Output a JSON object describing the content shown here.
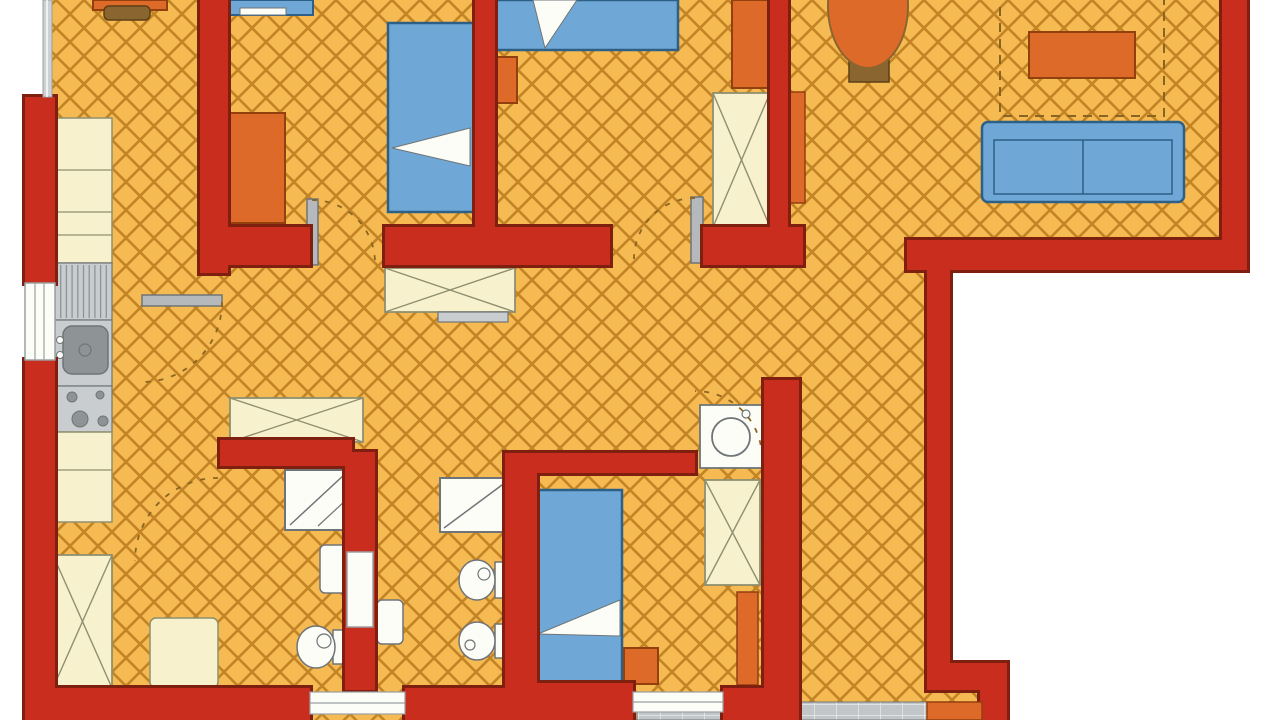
{
  "meta": {
    "type": "apartment-floor-plan",
    "canvas": {
      "width": 1280,
      "height": 720
    }
  },
  "palette": {
    "bg": "#ffffff",
    "floor_bg": "#f6ba52",
    "floor_line": "#c28425",
    "wall": "#c92d1d",
    "wall_dark": "#7e1f10",
    "blue": "#6fa8d6",
    "blue_dark": "#2e5f86",
    "orange": "#dd6a28",
    "orange_dark": "#93400f",
    "cream": "#f7f2cd",
    "cream_dark": "#8f8f70",
    "white": "#fdfdf8",
    "gray": "#b5b9bb",
    "gray_mid": "#c9cdcf",
    "gray_dark": "#6f7577",
    "steel": "#8e9496",
    "pave_bg": "#c2c6c8",
    "pave_line": "#e9ebeb",
    "pot": "#8a6530",
    "pot_dark": "#5d4015",
    "dash": "#8a6420",
    "win_glass": "#cdd1d3",
    "win_frame": "#9aa0a2"
  },
  "floor_polygon": "44,0 1247,0 1247,270 950,270 950,663 1007,663 1007,720 25,720 25,97 44,97",
  "balcony": {
    "x": 637,
    "y": 702,
    "w": 293,
    "h": 18
  },
  "furniture": [
    {
      "k": "rect",
      "n": "kitchen-desk",
      "x": 93,
      "y": 0,
      "w": 74,
      "h": 10,
      "f": "orange",
      "s": "orange_dark",
      "sw": 2
    },
    {
      "k": "rect",
      "n": "kitchen-chair",
      "x": 104,
      "y": 6,
      "w": 46,
      "h": 14,
      "rx": 5,
      "f": "pot",
      "s": "pot_dark",
      "sw": 1.5
    },
    {
      "k": "rect",
      "n": "kitchen-counter-upper",
      "x": 55,
      "y": 118,
      "w": 57,
      "h": 145,
      "f": "cream",
      "s": "cream_dark",
      "sw": 1.5
    },
    {
      "k": "line",
      "n": "counter-line",
      "x1": 55,
      "y1": 170,
      "x2": 112,
      "y2": 170,
      "s": "cream_dark",
      "sw": 1.2
    },
    {
      "k": "line",
      "n": "counter-line",
      "x1": 55,
      "y1": 212,
      "x2": 112,
      "y2": 212,
      "s": "cream_dark",
      "sw": 1.2
    },
    {
      "k": "line",
      "n": "counter-line",
      "x1": 55,
      "y1": 235,
      "x2": 112,
      "y2": 235,
      "s": "cream_dark",
      "sw": 1.2
    },
    {
      "k": "hatch",
      "n": "kitchen-drainer",
      "x": 55,
      "y": 263,
      "w": 57,
      "h": 57,
      "f": "gray_mid",
      "s": "gray_dark",
      "sw": 1.2,
      "lines": 9,
      "dir": "v"
    },
    {
      "k": "rect",
      "n": "kitchen-sink-counter",
      "x": 55,
      "y": 320,
      "w": 57,
      "h": 66,
      "f": "gray_mid",
      "s": "gray_dark",
      "sw": 1.2
    },
    {
      "k": "rect",
      "n": "kitchen-sink-basin",
      "x": 63,
      "y": 326,
      "w": 45,
      "h": 48,
      "rx": 9,
      "f": "steel",
      "s": "gray_dark",
      "sw": 1.5
    },
    {
      "k": "ellipse",
      "n": "faucet-dot",
      "cx": 60,
      "cy": 340,
      "rx": 3.5,
      "ry": 3.5,
      "f": "white",
      "s": "gray_dark",
      "sw": 1
    },
    {
      "k": "ellipse",
      "n": "faucet-dot",
      "cx": 60,
      "cy": 355,
      "rx": 3.5,
      "ry": 3.5,
      "f": "white",
      "s": "gray_dark",
      "sw": 1
    },
    {
      "k": "ellipse",
      "n": "sink-drain",
      "cx": 85,
      "cy": 350,
      "rx": 6,
      "ry": 6,
      "f": "none",
      "s": "gray_dark",
      "sw": 1.2
    },
    {
      "k": "rect",
      "n": "kitchen-stove",
      "x": 55,
      "y": 386,
      "w": 57,
      "h": 46,
      "f": "gray_mid",
      "s": "gray_dark",
      "sw": 1.2
    },
    {
      "k": "ellipse",
      "n": "stove-burner",
      "cx": 72,
      "cy": 397,
      "rx": 5,
      "ry": 5,
      "f": "steel",
      "s": "gray_dark",
      "sw": 1
    },
    {
      "k": "ellipse",
      "n": "stove-burner",
      "cx": 100,
      "cy": 395,
      "rx": 4,
      "ry": 4,
      "f": "steel",
      "s": "gray_dark",
      "sw": 1
    },
    {
      "k": "ellipse",
      "n": "stove-burner",
      "cx": 80,
      "cy": 419,
      "rx": 8,
      "ry": 8,
      "f": "steel",
      "s": "gray_dark",
      "sw": 1
    },
    {
      "k": "ellipse",
      "n": "stove-burner",
      "cx": 103,
      "cy": 421,
      "rx": 5,
      "ry": 5,
      "f": "steel",
      "s": "gray_dark",
      "sw": 1
    },
    {
      "k": "rect",
      "n": "kitchen-counter-lower",
      "x": 55,
      "y": 432,
      "w": 57,
      "h": 90,
      "f": "cream",
      "s": "cream_dark",
      "sw": 1.5
    },
    {
      "k": "line",
      "n": "counter-line",
      "x1": 55,
      "y1": 470,
      "x2": 112,
      "y2": 470,
      "s": "cream_dark",
      "sw": 1.2
    },
    {
      "k": "xbox",
      "n": "entry-wardrobe",
      "x": 53,
      "y": 555,
      "w": 59,
      "h": 133
    },
    {
      "k": "rect",
      "n": "entry-cabinet",
      "x": 150,
      "y": 618,
      "w": 68,
      "h": 70,
      "rx": 6,
      "f": "cream",
      "s": "cream_dark",
      "sw": 1.5
    },
    {
      "k": "rect",
      "n": "bed-1-stub",
      "x": 230,
      "y": 0,
      "w": 83,
      "h": 15,
      "f": "blue",
      "s": "blue_dark",
      "sw": 2
    },
    {
      "k": "rect",
      "n": "bed-1-stub-pillow",
      "x": 240,
      "y": 8,
      "w": 46,
      "h": 7,
      "f": "white",
      "s": "gray_dark",
      "sw": 1
    },
    {
      "k": "rect",
      "n": "bedroom1-dresser",
      "x": 230,
      "y": 113,
      "w": 55,
      "h": 110,
      "f": "orange",
      "s": "orange_dark",
      "sw": 2
    },
    {
      "k": "rect",
      "n": "bed-1",
      "x": 388,
      "y": 23,
      "w": 87,
      "h": 189,
      "f": "blue",
      "s": "blue_dark",
      "sw": 2.5
    },
    {
      "k": "polygon",
      "n": "bed-1-blanket",
      "points": "392,148 470,128 470,166",
      "f": "white",
      "s": "gray_dark",
      "sw": 1
    },
    {
      "k": "rect",
      "n": "bed-2",
      "x": 490,
      "y": 0,
      "w": 188,
      "h": 50,
      "f": "blue",
      "s": "blue_dark",
      "sw": 2.5
    },
    {
      "k": "polygon",
      "n": "bed-2-pillow",
      "points": "533,0 577,0 545,48",
      "f": "white",
      "s": "gray_dark",
      "sw": 1
    },
    {
      "k": "rect",
      "n": "bedroom2-nightstand",
      "x": 487,
      "y": 57,
      "w": 30,
      "h": 46,
      "f": "orange",
      "s": "orange_dark",
      "sw": 2
    },
    {
      "k": "rect",
      "n": "bedroom2-cabinet",
      "x": 732,
      "y": 0,
      "w": 38,
      "h": 88,
      "f": "orange",
      "s": "orange_dark",
      "sw": 2
    },
    {
      "k": "xbox",
      "n": "bedroom2-wardrobe",
      "x": 713,
      "y": 93,
      "w": 57,
      "h": 134
    },
    {
      "k": "xbox",
      "n": "hall-wardrobe",
      "x": 385,
      "y": 268,
      "w": 130,
      "h": 44
    },
    {
      "k": "rect",
      "n": "hall-shelf",
      "x": 438,
      "y": 312,
      "w": 70,
      "h": 10,
      "f": "gray_mid",
      "s": "gray_dark",
      "sw": 1.2
    },
    {
      "k": "xbox",
      "n": "hall-wardrobe-2",
      "x": 230,
      "y": 398,
      "w": 133,
      "h": 44
    },
    {
      "k": "rect",
      "n": "washing-machine",
      "x": 700,
      "y": 405,
      "w": 62,
      "h": 63,
      "f": "white",
      "s": "gray_dark",
      "sw": 1.8
    },
    {
      "k": "ellipse",
      "n": "washer-drum",
      "cx": 731,
      "cy": 437,
      "rx": 19,
      "ry": 19,
      "f": "none",
      "s": "gray_dark",
      "sw": 1.8
    },
    {
      "k": "ellipse",
      "n": "washer-knob",
      "cx": 746,
      "cy": 414,
      "rx": 4,
      "ry": 4,
      "f": "none",
      "s": "gray_dark",
      "sw": 1.2
    },
    {
      "k": "rect",
      "n": "plant-pot",
      "x": 849,
      "y": 56,
      "w": 40,
      "h": 26,
      "f": "pot",
      "s": "pot_dark",
      "sw": 1.5
    },
    {
      "k": "ellipse",
      "n": "plant",
      "cx": 868,
      "cy": 6,
      "rx": 40,
      "ry": 62,
      "f": "orange",
      "s": "pot",
      "sw": 2
    },
    {
      "k": "rect",
      "n": "rug-outline",
      "x": 1000,
      "y": -16,
      "w": 164,
      "h": 132,
      "f": "none",
      "s": "dash",
      "sw": 2,
      "dash": "9 7"
    },
    {
      "k": "rect",
      "n": "coffee-table",
      "x": 1029,
      "y": 32,
      "w": 106,
      "h": 46,
      "f": "orange",
      "s": "orange_dark",
      "sw": 2
    },
    {
      "k": "rect",
      "n": "sofa",
      "x": 982,
      "y": 122,
      "w": 202,
      "h": 80,
      "rx": 6,
      "f": "blue",
      "s": "blue_dark",
      "sw": 2.5
    },
    {
      "k": "rect",
      "n": "sofa-seat",
      "x": 994,
      "y": 140,
      "w": 178,
      "h": 54,
      "f": "none",
      "s": "blue_dark",
      "sw": 1.5
    },
    {
      "k": "line",
      "n": "sofa-divider",
      "x1": 1083,
      "y1": 140,
      "x2": 1083,
      "y2": 194,
      "s": "blue_dark",
      "sw": 1.5
    },
    {
      "k": "rect",
      "n": "shower-1",
      "x": 285,
      "y": 470,
      "w": 65,
      "h": 60,
      "f": "white",
      "s": "gray_dark",
      "sw": 2
    },
    {
      "k": "line",
      "n": "shower-1-diagonal",
      "x1": 290,
      "y1": 525,
      "x2": 345,
      "y2": 474,
      "s": "gray_dark",
      "sw": 1.5
    },
    {
      "k": "line",
      "n": "shower-1-diagonal",
      "x1": 318,
      "y1": 526,
      "x2": 346,
      "y2": 500,
      "s": "gray_dark",
      "sw": 1.2
    },
    {
      "k": "rect",
      "n": "washbasin-1",
      "x": 320,
      "y": 545,
      "w": 28,
      "h": 48,
      "rx": 5,
      "f": "white",
      "s": "gray_dark",
      "sw": 1.5
    },
    {
      "k": "rect",
      "n": "toilet-1-tank",
      "x": 333,
      "y": 630,
      "w": 15,
      "h": 34,
      "f": "white",
      "s": "gray_dark",
      "sw": 1.5
    },
    {
      "k": "ellipse",
      "n": "toilet-1-bowl",
      "cx": 316,
      "cy": 647,
      "rx": 19,
      "ry": 21,
      "f": "white",
      "s": "gray_dark",
      "sw": 1.5
    },
    {
      "k": "ellipse",
      "n": "toilet-1-flush",
      "cx": 324,
      "cy": 641,
      "rx": 7,
      "ry": 7,
      "f": "none",
      "s": "gray_dark",
      "sw": 1.2
    },
    {
      "k": "rect",
      "n": "shower-2",
      "x": 440,
      "y": 478,
      "w": 72,
      "h": 54,
      "f": "white",
      "s": "gray_dark",
      "sw": 2
    },
    {
      "k": "line",
      "n": "shower-2-diagonal",
      "x1": 444,
      "y1": 528,
      "x2": 506,
      "y2": 482,
      "s": "gray_dark",
      "sw": 1.5
    },
    {
      "k": "rect",
      "n": "washbasin-2",
      "x": 377,
      "y": 600,
      "w": 26,
      "h": 44,
      "rx": 5,
      "f": "white",
      "s": "gray_dark",
      "sw": 1.5
    },
    {
      "k": "rect",
      "n": "toilet-2-tank",
      "x": 495,
      "y": 562,
      "w": 15,
      "h": 36,
      "f": "white",
      "s": "gray_dark",
      "sw": 1.5
    },
    {
      "k": "ellipse",
      "n": "toilet-2-bowl",
      "cx": 477,
      "cy": 580,
      "rx": 18,
      "ry": 20,
      "f": "white",
      "s": "gray_dark",
      "sw": 1.5
    },
    {
      "k": "ellipse",
      "n": "toilet-2-flush",
      "cx": 484,
      "cy": 574,
      "rx": 6,
      "ry": 6,
      "f": "none",
      "s": "gray_dark",
      "sw": 1.2
    },
    {
      "k": "rect",
      "n": "bidet-tank",
      "x": 495,
      "y": 624,
      "w": 15,
      "h": 34,
      "f": "white",
      "s": "gray_dark",
      "sw": 1.5
    },
    {
      "k": "ellipse",
      "n": "bidet-bowl",
      "cx": 477,
      "cy": 641,
      "rx": 18,
      "ry": 19,
      "f": "white",
      "s": "gray_dark",
      "sw": 1.5
    },
    {
      "k": "ellipse",
      "n": "bidet-drain",
      "cx": 470,
      "cy": 645,
      "rx": 5,
      "ry": 5,
      "f": "none",
      "s": "gray_dark",
      "sw": 1.2
    },
    {
      "k": "rect",
      "n": "bed-3",
      "x": 535,
      "y": 490,
      "w": 87,
      "h": 196,
      "f": "blue",
      "s": "blue_dark",
      "sw": 2.5
    },
    {
      "k": "polygon",
      "n": "bed-3-blanket",
      "points": "538,634 620,600 620,636",
      "f": "white",
      "s": "gray_dark",
      "sw": 1
    },
    {
      "k": "rect",
      "n": "bedroom3-nightstand",
      "x": 624,
      "y": 648,
      "w": 34,
      "h": 36,
      "f": "orange",
      "s": "orange_dark",
      "sw": 2
    },
    {
      "k": "xbox",
      "n": "bedroom3-wardrobe",
      "x": 705,
      "y": 480,
      "w": 55,
      "h": 105
    },
    {
      "k": "rect",
      "n": "bedroom3-door-leaf",
      "x": 737,
      "y": 592,
      "w": 21,
      "h": 93,
      "f": "orange",
      "s": "orange_dark",
      "sw": 1.5
    },
    {
      "k": "rect",
      "n": "living-door-leaf",
      "x": 788,
      "y": 92,
      "w": 17,
      "h": 111,
      "f": "orange",
      "s": "orange_dark",
      "sw": 1.5
    },
    {
      "k": "rect",
      "n": "kitchen-door-leaf",
      "x": 142,
      "y": 295,
      "w": 80,
      "h": 11,
      "f": "gray",
      "s": "gray_dark",
      "sw": 1.5
    },
    {
      "k": "rect",
      "n": "bedroom1-door-leaf",
      "x": 307,
      "y": 199,
      "w": 11,
      "h": 66,
      "f": "gray",
      "s": "gray_dark",
      "sw": 1.5
    },
    {
      "k": "rect",
      "n": "bedroom2-door-leaf",
      "x": 691,
      "y": 197,
      "w": 12,
      "h": 66,
      "f": "gray",
      "s": "gray_dark",
      "sw": 1.5
    },
    {
      "k": "path",
      "n": "kitchen-door-arc",
      "d": "M 222,302 A 80 80 0 0 1 142,382",
      "f": "none",
      "s": "dash",
      "sw": 1.8,
      "dash": "5 8"
    },
    {
      "k": "path",
      "n": "bedroom1-door-arc",
      "d": "M 312,200 A 63 63 0 0 1 375,263",
      "f": "none",
      "s": "dash",
      "sw": 1.8,
      "dash": "5 8"
    },
    {
      "k": "path",
      "n": "bedroom2-door-arc",
      "d": "M 695,198 A 61 61 0 0 0 634,259",
      "f": "none",
      "s": "dash",
      "sw": 1.8,
      "dash": "5 8"
    },
    {
      "k": "path",
      "n": "bedroom3-door-arc",
      "d": "M 762,458 A 67 67 0 0 0 695,391",
      "f": "none",
      "s": "dash",
      "sw": 1.8,
      "dash": "5 8"
    },
    {
      "k": "path",
      "n": "bathroom1-door-arc",
      "d": "M 218,478 A 83 83 0 0 0 135,561",
      "f": "none",
      "s": "dash",
      "sw": 1.8,
      "dash": "5 8"
    }
  ],
  "walls": [
    {
      "n": "wall-left-top",
      "x": 25,
      "y": 97,
      "w": 30,
      "h": 186
    },
    {
      "n": "wall-left-bottom",
      "x": 25,
      "y": 360,
      "w": 30,
      "h": 360
    },
    {
      "n": "wall-bottom-left",
      "x": 25,
      "y": 688,
      "w": 285,
      "h": 32
    },
    {
      "n": "wall-kitchen-right",
      "x": 200,
      "y": 0,
      "w": 28,
      "h": 273
    },
    {
      "n": "wall-bedroom-divider",
      "x": 475,
      "y": 0,
      "w": 20,
      "h": 238
    },
    {
      "n": "wall-hall-top-a",
      "x": 225,
      "y": 227,
      "w": 85,
      "h": 38
    },
    {
      "n": "wall-hall-top-b",
      "x": 385,
      "y": 227,
      "w": 225,
      "h": 38
    },
    {
      "n": "wall-hall-top-c",
      "x": 703,
      "y": 227,
      "w": 100,
      "h": 38
    },
    {
      "n": "wall-closet-thin",
      "x": 770,
      "y": 0,
      "w": 18,
      "h": 230
    },
    {
      "n": "wall-living-bottom",
      "x": 907,
      "y": 240,
      "w": 340,
      "h": 30
    },
    {
      "n": "wall-living-right",
      "x": 1222,
      "y": 0,
      "w": 25,
      "h": 250
    },
    {
      "n": "wall-corridor-right",
      "x": 927,
      "y": 270,
      "w": 23,
      "h": 395
    },
    {
      "n": "wall-corridor-step-h",
      "x": 927,
      "y": 663,
      "w": 80,
      "h": 27
    },
    {
      "n": "wall-corridor-step-v",
      "x": 980,
      "y": 690,
      "w": 27,
      "h": 30
    },
    {
      "n": "wall-bedroom3-corridor",
      "x": 764,
      "y": 380,
      "w": 35,
      "h": 340
    },
    {
      "n": "wall-bathroom1-top",
      "x": 220,
      "y": 440,
      "w": 132,
      "h": 26
    },
    {
      "n": "wall-bathroom-divider",
      "x": 345,
      "y": 452,
      "w": 30,
      "h": 238
    },
    {
      "n": "wall-bathroom2-right",
      "x": 505,
      "y": 453,
      "w": 32,
      "h": 237
    },
    {
      "n": "wall-bedroom3-top",
      "x": 537,
      "y": 453,
      "w": 158,
      "h": 20
    },
    {
      "n": "wall-bottom-mid",
      "x": 405,
      "y": 688,
      "w": 102,
      "h": 32
    },
    {
      "n": "wall-bedroom3-bottom",
      "x": 505,
      "y": 683,
      "w": 128,
      "h": 37
    },
    {
      "n": "wall-bottom-stub",
      "x": 723,
      "y": 688,
      "w": 41,
      "h": 32
    }
  ],
  "overlays": [
    {
      "k": "rect",
      "n": "window-top-left",
      "x": 43,
      "y": 0,
      "w": 9,
      "h": 97,
      "f": "win_glass",
      "s": "win_frame",
      "sw": 1
    },
    {
      "k": "line",
      "n": "window-top-left-pane",
      "x1": 47,
      "y1": 0,
      "x2": 47,
      "y2": 97,
      "s": "white",
      "sw": 1.5
    },
    {
      "k": "rect",
      "n": "window-left",
      "x": 25,
      "y": 283,
      "w": 30,
      "h": 77,
      "f": "white",
      "s": "win_frame",
      "sw": 1.5
    },
    {
      "k": "line",
      "n": "window-left-pane",
      "x1": 35,
      "y1": 283,
      "x2": 35,
      "y2": 360,
      "s": "win_frame",
      "sw": 1.2
    },
    {
      "k": "line",
      "n": "window-left-pane",
      "x1": 44,
      "y1": 283,
      "x2": 44,
      "y2": 360,
      "s": "win_frame",
      "sw": 1.2
    },
    {
      "k": "rect",
      "n": "window-bottom-1",
      "x": 310,
      "y": 692,
      "w": 95,
      "h": 22,
      "f": "white",
      "s": "win_frame",
      "sw": 1.2
    },
    {
      "k": "line",
      "n": "window-bottom-1-pane",
      "x1": 310,
      "y1": 703,
      "x2": 405,
      "y2": 703,
      "s": "win_frame",
      "sw": 1.2
    },
    {
      "k": "rect",
      "n": "window-bottom-2",
      "x": 633,
      "y": 692,
      "w": 90,
      "h": 20,
      "f": "white",
      "s": "win_frame",
      "sw": 1.2
    },
    {
      "k": "line",
      "n": "window-bottom-2-pane",
      "x1": 633,
      "y1": 702,
      "x2": 723,
      "y2": 702,
      "s": "win_frame",
      "sw": 1.2
    },
    {
      "k": "rect",
      "n": "bathroom2-door",
      "x": 347,
      "y": 552,
      "w": 26,
      "h": 75,
      "f": "white",
      "s": "win_frame",
      "sw": 1.5
    },
    {
      "k": "rect",
      "n": "entry-mat",
      "x": 927,
      "y": 702,
      "w": 55,
      "h": 18,
      "f": "orange",
      "s": "orange_dark",
      "sw": 1.5
    }
  ]
}
